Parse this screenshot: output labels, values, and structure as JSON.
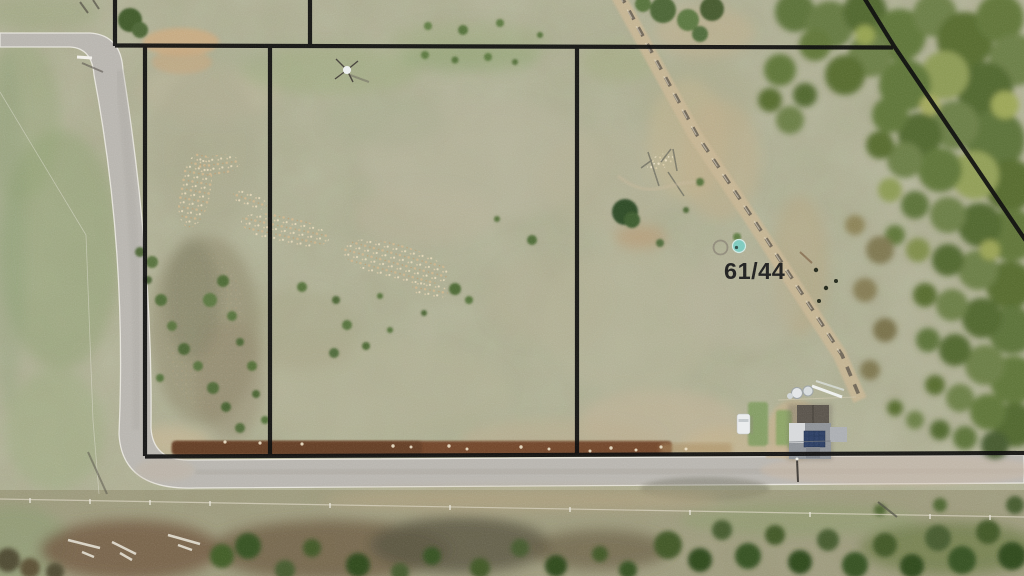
{
  "scene": {
    "parcel_label": "61/44"
  },
  "palette": {
    "boundary_line": "#0d0d0d",
    "label_text": "#1f1f1f",
    "grass_base": "#a9a78c",
    "lawn_green": "#8fa172",
    "road_surface": "#b7b4ae",
    "road_edge": "#edebe4",
    "dirt_track": "#c6b492",
    "dirt_berm": "#6f452a",
    "tree_olive": "#6b7c46",
    "tree_dark": "#3c5228",
    "solar_panel": "#2c3e63",
    "water_tank_teal": "#7cc9bd",
    "vehicle_white": "#e9ebec"
  }
}
